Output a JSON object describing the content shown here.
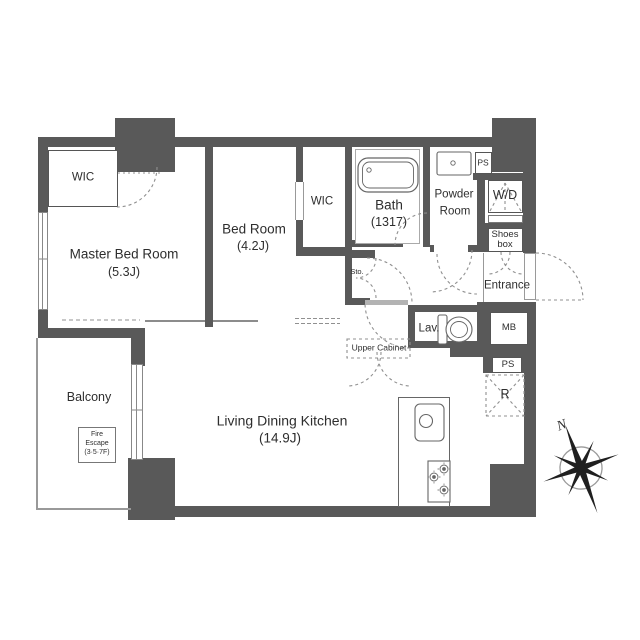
{
  "colors": {
    "wall": "#595959",
    "thin_line": "#666666",
    "dashed": "#909090",
    "text": "#2e2e2e"
  },
  "rooms": {
    "master_bedroom": {
      "name": "Master Bed Room",
      "size": "(5.3J)"
    },
    "bedroom": {
      "name": "Bed Room",
      "size": "(4.2J)"
    },
    "wic_master": {
      "label": "WIC"
    },
    "wic_bedroom": {
      "label": "WIC"
    },
    "bath": {
      "name": "Bath",
      "size": "(1317)"
    },
    "powder_room": {
      "line1": "Powder",
      "line2": "Room"
    },
    "lavatory": {
      "label": "Lav."
    },
    "entrance": {
      "label": "Entrance"
    },
    "ldk": {
      "name": "Living Dining Kitchen",
      "size": "(14.9J)"
    },
    "balcony": {
      "label": "Balcony"
    }
  },
  "storage": {
    "sto": {
      "label": "Sto."
    },
    "upper_cabinet": {
      "label": "Upper Cabinet"
    },
    "shoes_box": {
      "line1": "Shoes",
      "line2": "box"
    },
    "washer_dryer": {
      "label": "W/D"
    }
  },
  "utility": {
    "ps_top": {
      "label": "PS"
    },
    "ps_lower": {
      "label": "PS"
    },
    "meter_box": {
      "label": "MB"
    },
    "refrigerator": {
      "label": "R"
    }
  },
  "balcony_extras": {
    "fire_escape": {
      "line1": "Fire",
      "line2": "Escape",
      "line3": "(3·5·7F)"
    }
  },
  "compass": {
    "north_label": "N"
  }
}
